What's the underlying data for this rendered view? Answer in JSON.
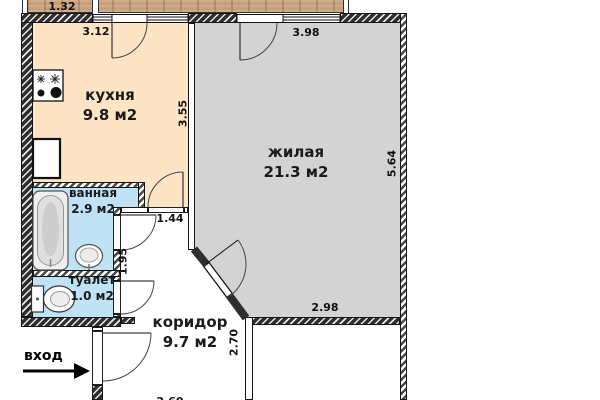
{
  "plan": {
    "type": "apartment floor plan",
    "entrance_label": "вход",
    "rooms": [
      {
        "name": "кухня",
        "area": "9.8 м2"
      },
      {
        "name": "жилая",
        "area": "21.3 м2"
      },
      {
        "name": "ванная",
        "area": "2.9 м2"
      },
      {
        "name": "туалет",
        "area": "1.0 м2"
      },
      {
        "name": "коридор",
        "area": "9.7 м2"
      }
    ],
    "dimensions": {
      "balcony_section": "1.32",
      "kitchen_top": "3.12",
      "kitchen_side": "3.55",
      "living_top": "3.98",
      "living_side": "5.64",
      "living_bottom": "2.98",
      "corridor_top": "1.44",
      "bathroom_side": "1.95",
      "corridor_side": "2.70",
      "bottom_partial": "2.60"
    },
    "colors": {
      "kitchen_fill": "#fce4c4",
      "living_fill": "#d3d3d3",
      "wet_room_fill": "#bfe2f5",
      "balcony_wood": "#c6a07a",
      "wall_dark": "#2e2e2e",
      "line": "#151515"
    },
    "icons": [
      "stove-icon",
      "bathtub-icon",
      "sink-icon",
      "toilet-icon",
      "entrance-arrow-icon"
    ]
  }
}
